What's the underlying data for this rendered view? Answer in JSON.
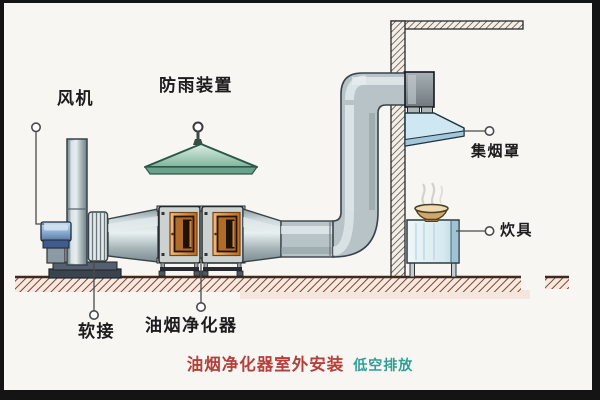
{
  "diagram": {
    "labels": {
      "fan": "风机",
      "rain_shield": "防雨装置",
      "smoke_hood": "集烟罩",
      "cooker": "炊具",
      "flex_joint": "软接",
      "purifier": "油烟净化器"
    },
    "title": {
      "main": "油烟净化器室外安装",
      "sub": "低空排放"
    },
    "colors": {
      "title_main": "#b5403a",
      "title_sub": "#2f9e96",
      "duct_gray": "#b7c3c6",
      "purifier_orange": "#d98c4a",
      "hood_blue": "#cfe7f3",
      "rain_cap_green": "#8fc2a9",
      "fan_blue": "#8fb0d4",
      "ground_hatch_brown": "#7c4534",
      "wall_hatch_gray": "#4e463c",
      "label_text": "#1c1c1c"
    }
  }
}
